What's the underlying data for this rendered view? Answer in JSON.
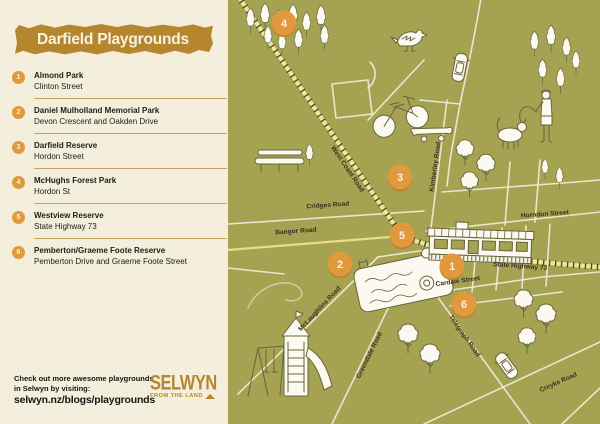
{
  "colors": {
    "panel_bg": "#f4eedd",
    "map_bg": "#a5a251",
    "accent_gold": "#b5862d",
    "marker_orange": "#e0993c",
    "divider_tan": "#c9a35c",
    "road_white": "#f1eddc",
    "road_yellow": "#e7e083",
    "rail_tie_dark": "#4c4b28",
    "text_dark": "#1f1e14"
  },
  "panel": {
    "title": "Darfield Playgrounds",
    "items": [
      {
        "n": "1",
        "name": "Almond Park",
        "address": "Clinton Street"
      },
      {
        "n": "2",
        "name": "Daniel Mulholland Memorial Park",
        "address": "Devon Crescent and Oakden Drive"
      },
      {
        "n": "3",
        "name": "Darfield Reserve",
        "address": "Hordon Street"
      },
      {
        "n": "4",
        "name": "McHughs Forest Park",
        "address": "Hordon St"
      },
      {
        "n": "5",
        "name": "Westview Reserve",
        "address": "State Highway 73"
      },
      {
        "n": "6",
        "name": "Pemberton/Graeme Foote Reserve",
        "address": "Pemberton Drive and Graeme Foote Street"
      }
    ],
    "footer": {
      "line1": "Check out more awesome playgrounds",
      "line2": "in Selwyn by visiting:",
      "url": "selwyn.nz/blogs/playgrounds"
    },
    "logo": {
      "name": "SELWYN",
      "tagline": "FROM THE LAND"
    }
  },
  "map": {
    "road_labels": [
      {
        "label": "West Coast Road",
        "x": 118,
        "y": 170,
        "rot": 56
      },
      {
        "label": "Cridges Road",
        "x": 100,
        "y": 207,
        "rot": -4
      },
      {
        "label": "Bangor Road",
        "x": 68,
        "y": 233,
        "rot": -4
      },
      {
        "label": "Kimberley Road",
        "x": 209,
        "y": 167,
        "rot": -82
      },
      {
        "label": "Horndon Street",
        "x": 317,
        "y": 216,
        "rot": -4
      },
      {
        "label": "State Highway 73",
        "x": 292,
        "y": 268,
        "rot": 4
      },
      {
        "label": "Cardale Street",
        "x": 230,
        "y": 283,
        "rot": -8
      },
      {
        "label": "McLaughlins Road",
        "x": 93,
        "y": 310,
        "rot": -47
      },
      {
        "label": "Greendale Road",
        "x": 143,
        "y": 356,
        "rot": -64
      },
      {
        "label": "Telegraph Road",
        "x": 235,
        "y": 337,
        "rot": 55
      },
      {
        "label": "Creyke Road",
        "x": 331,
        "y": 384,
        "rot": -24
      }
    ],
    "markers": [
      {
        "n": "1",
        "x": 224,
        "y": 266
      },
      {
        "n": "2",
        "x": 112,
        "y": 264
      },
      {
        "n": "3",
        "x": 172,
        "y": 177
      },
      {
        "n": "4",
        "x": 56,
        "y": 23
      },
      {
        "n": "5",
        "x": 174,
        "y": 235
      },
      {
        "n": "6",
        "x": 236,
        "y": 304
      }
    ],
    "illustrations": [
      "pine-tree",
      "puff-tree",
      "bird",
      "car",
      "bicycle",
      "skateboard",
      "bench",
      "person-walking-dog",
      "swimming-pool",
      "train",
      "playground-slide",
      "swing-set",
      "railway-line"
    ]
  }
}
